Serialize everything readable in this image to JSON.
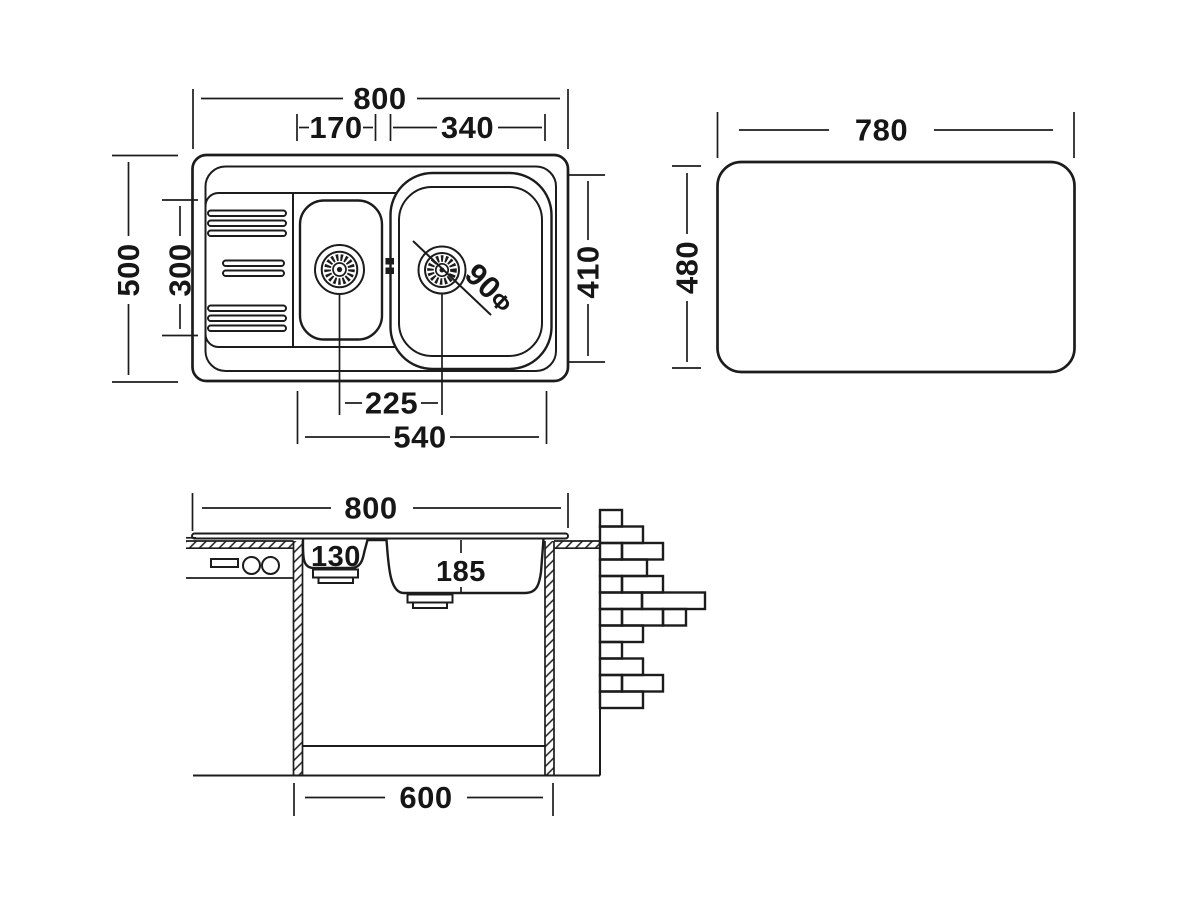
{
  "drawing": {
    "top_view": {
      "overall_width": "800",
      "small_bowl_width": "170",
      "large_bowl_width": "340",
      "overall_depth": "500",
      "bowl_area_depth": "300",
      "large_bowl_depth": "410",
      "drain_center_offset": "225",
      "bowls_overall_width": "540",
      "drain_diameter": "90",
      "drain_diameter_symbol": "Φ"
    },
    "cutout_view": {
      "cutout_width": "780",
      "cutout_height": "480"
    },
    "section_view": {
      "overall_width": "800",
      "small_bowl_depth": "130",
      "large_bowl_depth": "185",
      "cabinet_width": "600"
    },
    "colors": {
      "line_color": "#1c1c1c",
      "background": "#ffffff",
      "text_color": "#161616"
    }
  }
}
